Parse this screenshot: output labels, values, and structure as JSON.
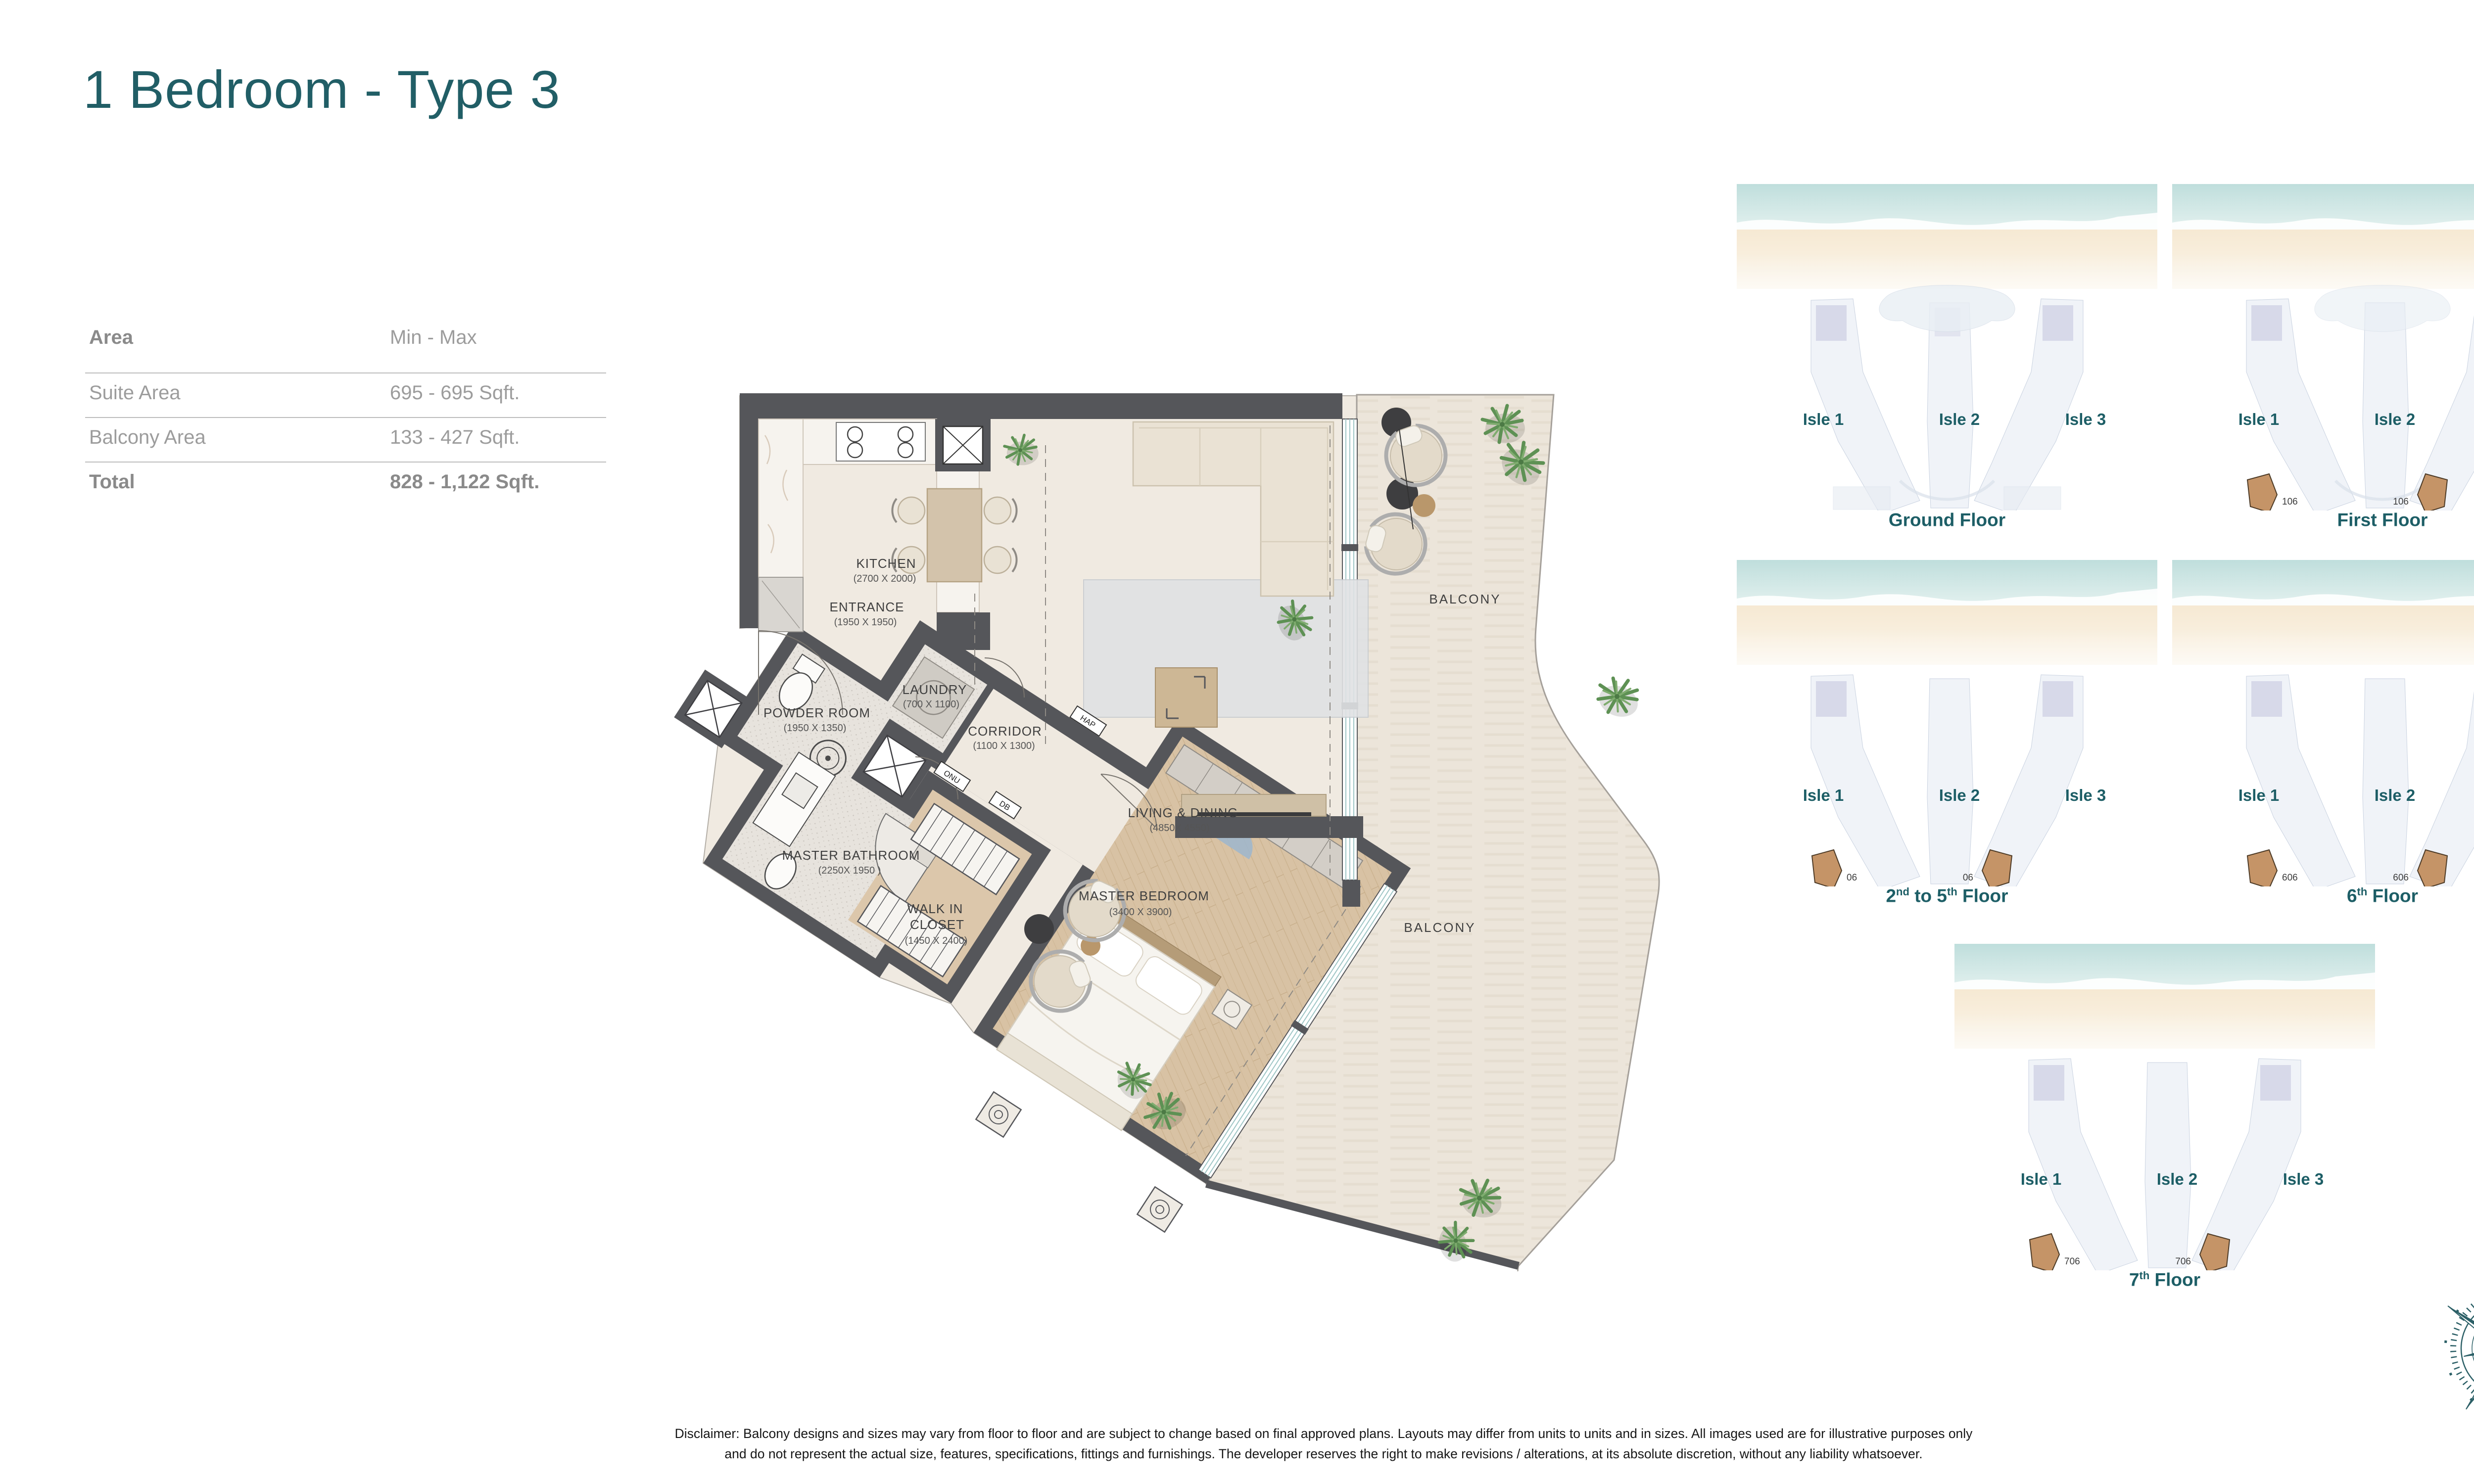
{
  "title": "1 Bedroom - Type 3",
  "colors": {
    "accent_teal": "#215E66",
    "wall_gray": "#55565A",
    "floor_beige": "#EFE9DF",
    "balcony_beige": "#EBE4D8",
    "wood": "#D8C2A4",
    "unit_highlight": "#C59467"
  },
  "area_table": {
    "header": {
      "label": "Area",
      "value": "Min - Max"
    },
    "rows": [
      {
        "label": "Suite Area",
        "value": "695 - 695 Sqft."
      },
      {
        "label": "Balcony Area",
        "value": "133 - 427 Sqft."
      },
      {
        "label": "Total",
        "value": "828 - 1,122 Sqft."
      }
    ]
  },
  "floorplan": {
    "rooms": [
      {
        "name": "KITCHEN",
        "dims": "(2700 X 2000)"
      },
      {
        "name": "ENTRANCE",
        "dims": "(1950 X 1950)"
      },
      {
        "name": "LIVING & DINING",
        "dims": "(4850X 4550)"
      },
      {
        "name": "POWDER ROOM",
        "dims": "(1950 X 1350)"
      },
      {
        "name": "LAUNDRY",
        "dims": "(700 X 1100)"
      },
      {
        "name": "CORRIDOR",
        "dims": "(1100 X 1300)"
      },
      {
        "name": "MASTER BATHROOM",
        "dims": "(2250X 1950 )"
      },
      {
        "name": "WALK IN",
        "name2": "CLOSET",
        "dims": "(1450 X 2400)"
      },
      {
        "name": "MASTER BEDROOM",
        "dims": "(3400 X 3900)"
      }
    ],
    "balcony_upper": "BALCONY",
    "balcony_lower": "BALCONY",
    "tags": {
      "hap": "HAP",
      "onu": "ONU",
      "db": "DB"
    }
  },
  "keyplans": [
    {
      "caption": {
        "a": "Ground Floor",
        "sa": "",
        "b": "",
        "sb": "",
        "c": ""
      },
      "isles": [
        "Isle 1",
        "Isle 2",
        "Isle 3"
      ],
      "units": []
    },
    {
      "caption": {
        "a": "First Floor",
        "sa": "",
        "b": "",
        "sb": "",
        "c": ""
      },
      "isles": [
        "Isle 1",
        "Isle 2",
        "Isle 3"
      ],
      "units": [
        "106",
        "106"
      ]
    },
    {
      "caption": {
        "a": "2",
        "sa": "nd",
        "b": " to 5",
        "sb": "th",
        "c": " Floor"
      },
      "isles": [
        "Isle 1",
        "Isle 2",
        "Isle 3"
      ],
      "units": [
        "06",
        "06"
      ]
    },
    {
      "caption": {
        "a": "6",
        "sa": "th",
        "b": " Floor",
        "sb": "",
        "c": ""
      },
      "isles": [
        "Isle 1",
        "Isle 2",
        "Isle 3"
      ],
      "units": [
        "606",
        "606"
      ]
    },
    {
      "caption": {
        "a": "7",
        "sa": "th",
        "b": " Floor",
        "sb": "",
        "c": ""
      },
      "isles": [
        "Isle 1",
        "Isle 2",
        "Isle 3"
      ],
      "units": [
        "706",
        "706"
      ]
    }
  ],
  "compass": {
    "north_label": "N"
  },
  "disclaimer": {
    "line1": "Disclaimer: Balcony designs and sizes may vary from floor to floor and are subject to change based on final approved plans. Layouts may differ from units to units and in sizes. All images used are for illustrative purposes only",
    "line2": "and do not represent the actual size, features, specifications, fittings and furnishings. The developer reserves the right to make revisions / alterations, at its absolute discretion, without any liability whatsoever."
  }
}
